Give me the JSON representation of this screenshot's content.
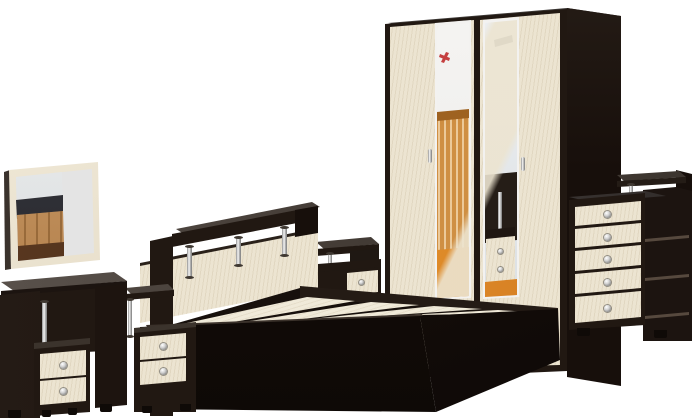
{
  "scene": {
    "title": "Bedroom furniture set - product photo on white background",
    "finish": "wenge dark brown with light beech (cream) fronts and chrome accents",
    "background": "#ffffff",
    "items": [
      {
        "id": "wall-mirror",
        "label": "Wall mirror in light beech frame reflecting room interior"
      },
      {
        "id": "dressing-table",
        "label": "Dressing table with chrome column and 2-drawer pedestal",
        "drawers": 2
      },
      {
        "id": "nightstand-left",
        "label": "Bedside cabinet with raised shelf on chrome post",
        "drawers": 2
      },
      {
        "id": "bed",
        "label": "Double bed with beech headboard, shelf on 3 chrome posts and 4 slat panels",
        "slats": 4,
        "headboard_posts": 3
      },
      {
        "id": "nightstand-right",
        "label": "Bedside cabinet with raised shelf on chrome post",
        "drawers": 1
      },
      {
        "id": "wardrobe",
        "label": "Two-door wardrobe with mirror strips reflecting nursery interior",
        "doors": 2,
        "mirrors": 2,
        "handles": "chrome"
      },
      {
        "id": "chest",
        "label": "Chest of drawers with raised chrome-post shelf and open side shelves",
        "drawers": 5,
        "side_shelves": 3
      }
    ]
  },
  "colors": {
    "white_bg": "#ffffff",
    "wenge_front": "#211812",
    "wenge_side": "#170f0b",
    "wenge_top_light": "#5a5350",
    "wenge_top_dark": "#2e2927",
    "cream": "#ece4d1",
    "cream_light": "#f0ead9",
    "chrome_hi": "#f2f2f2",
    "chrome_lo": "#7a7a7a",
    "mirror_gray": "#e4e4e4",
    "glass_white": "#f3f2f0",
    "floor_orange": "#ef9a37",
    "crib_wood": "#cf8f43",
    "scene_green": "#35a035",
    "mark_red": "#c54040",
    "knob_hi": "#ffffff",
    "knob_lo": "#777777"
  }
}
